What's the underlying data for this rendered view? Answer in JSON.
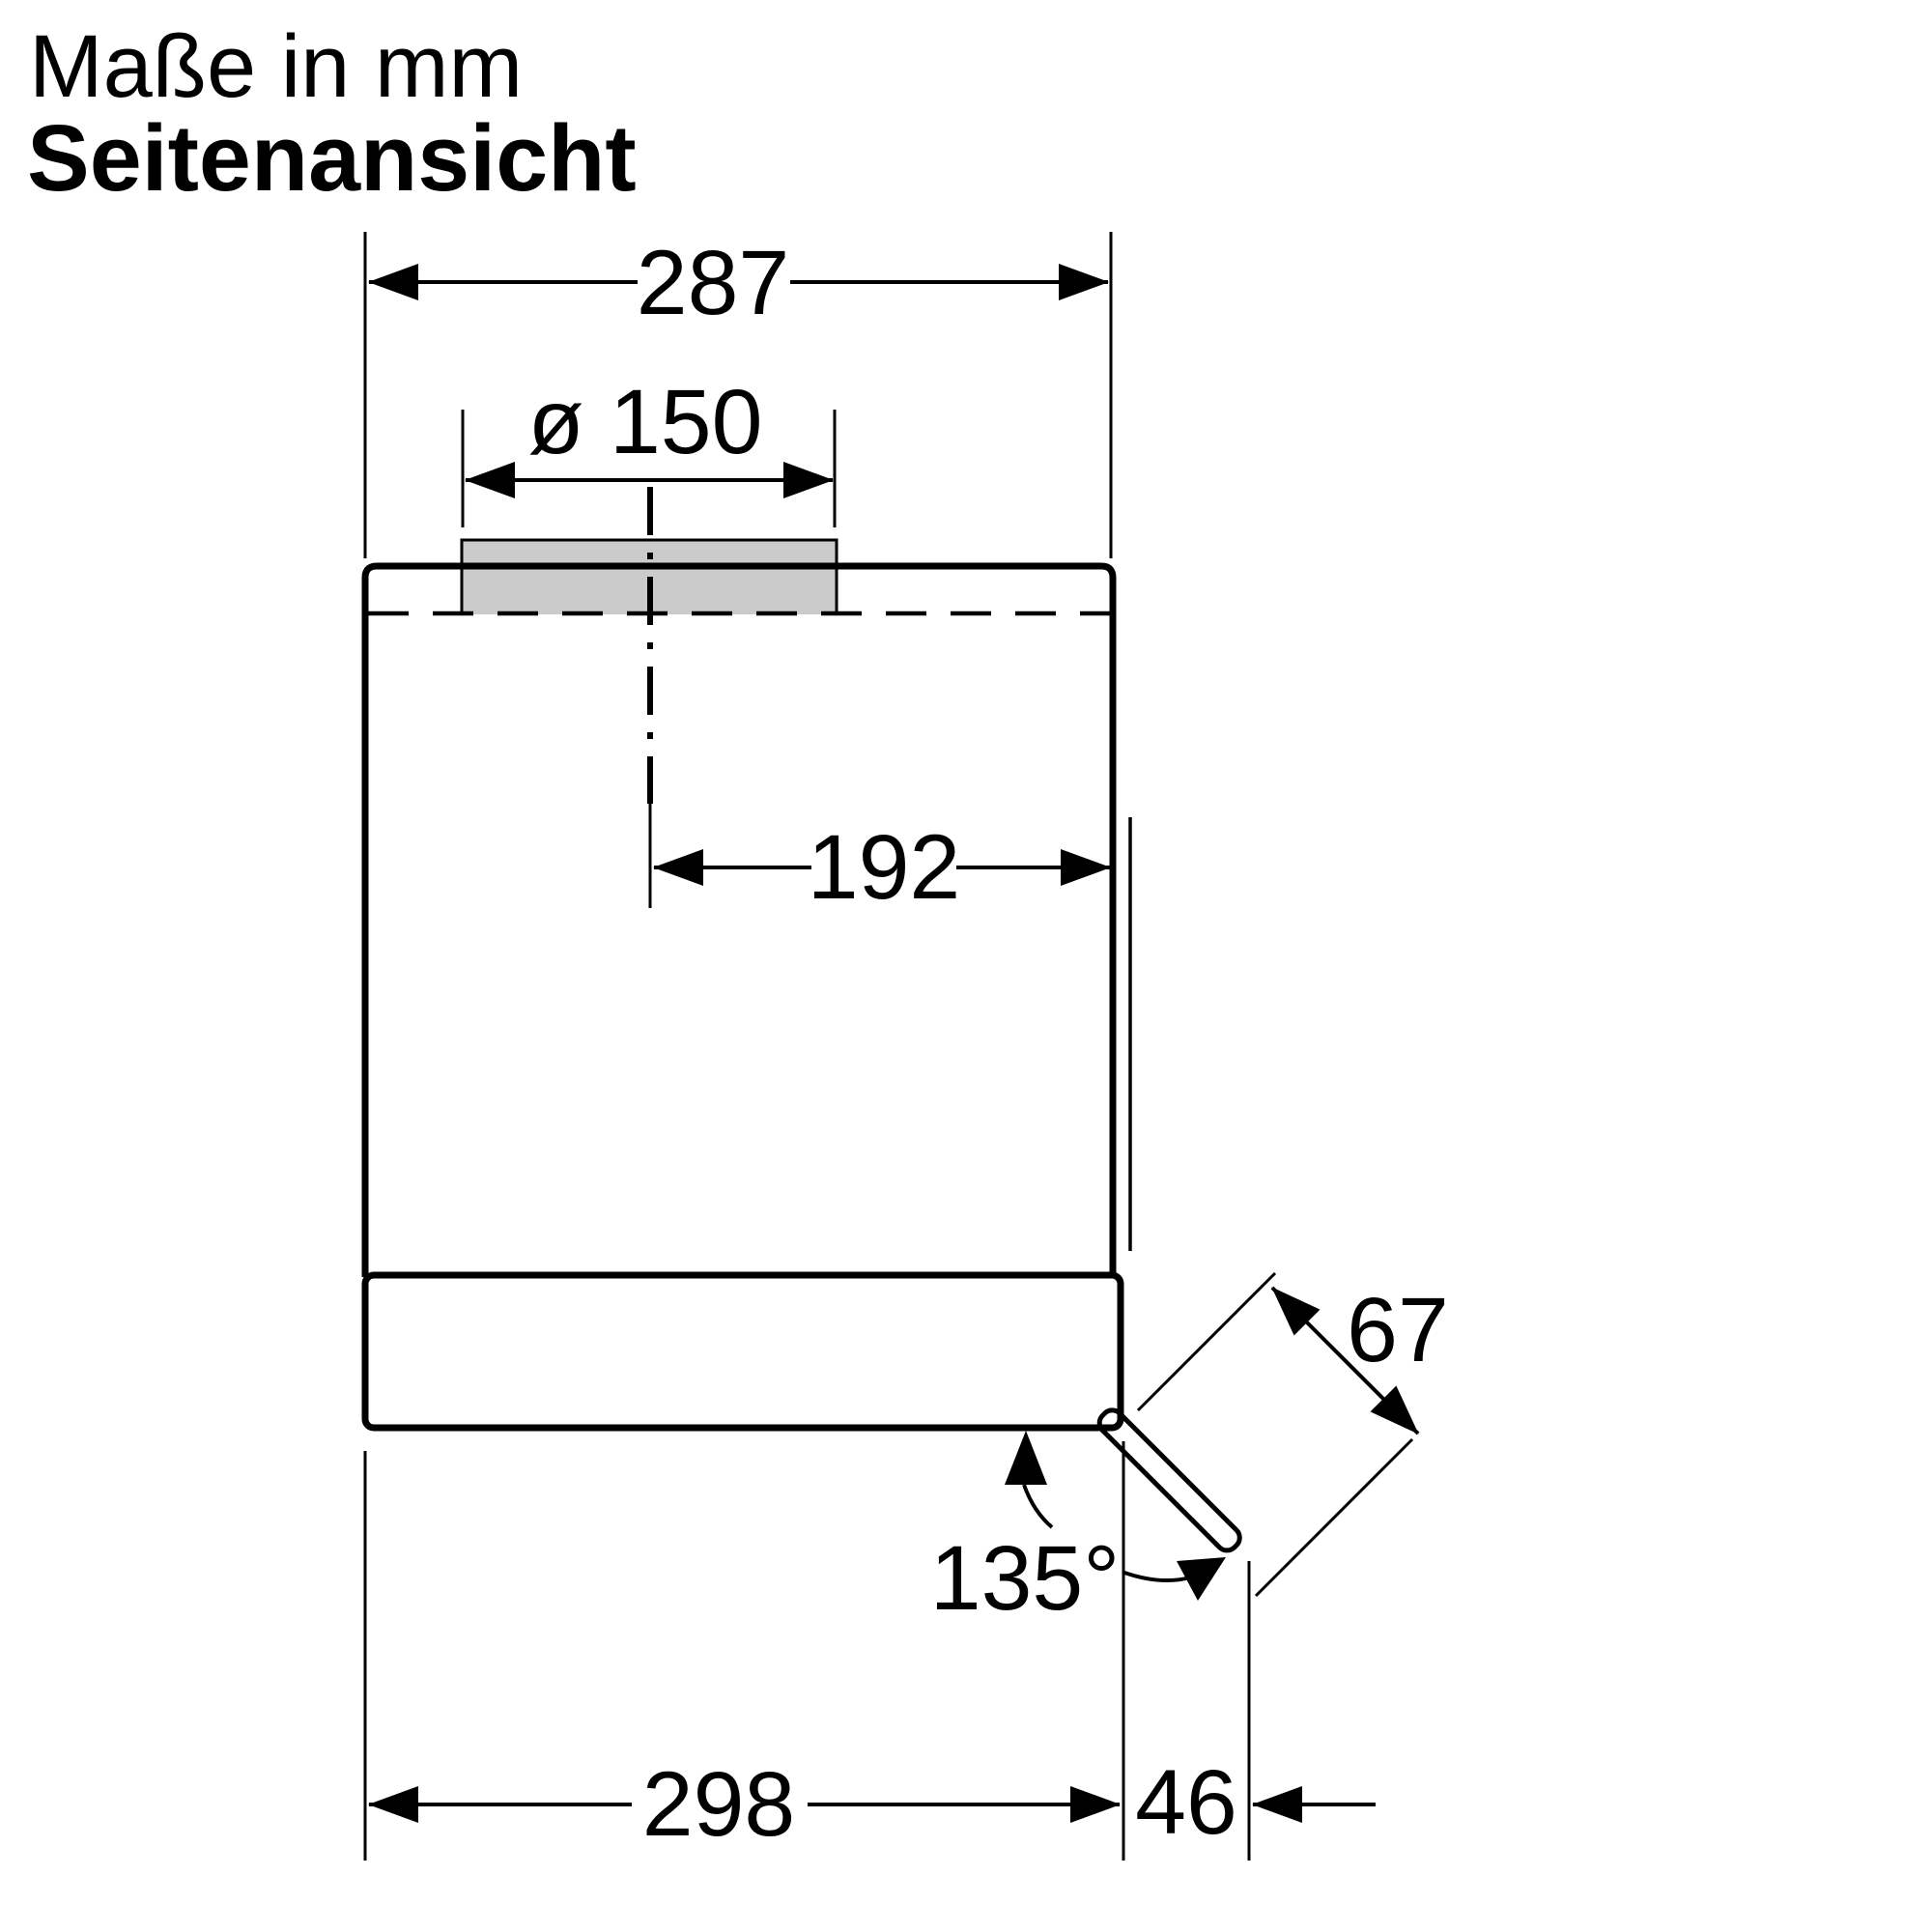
{
  "title": {
    "line1": "Maße in mm",
    "line2": "Seitenansicht"
  },
  "dimensions": {
    "body_width_top": "287",
    "duct_diameter": "ø 150",
    "center_to_wall": "192",
    "body_depth_bottom": "298",
    "rear_clearance": "46",
    "flap_length": "67",
    "flap_angle": "135°"
  },
  "colors": {
    "background": "#ffffff",
    "line": "#000000",
    "duct_fill": "#cbcbcb"
  }
}
